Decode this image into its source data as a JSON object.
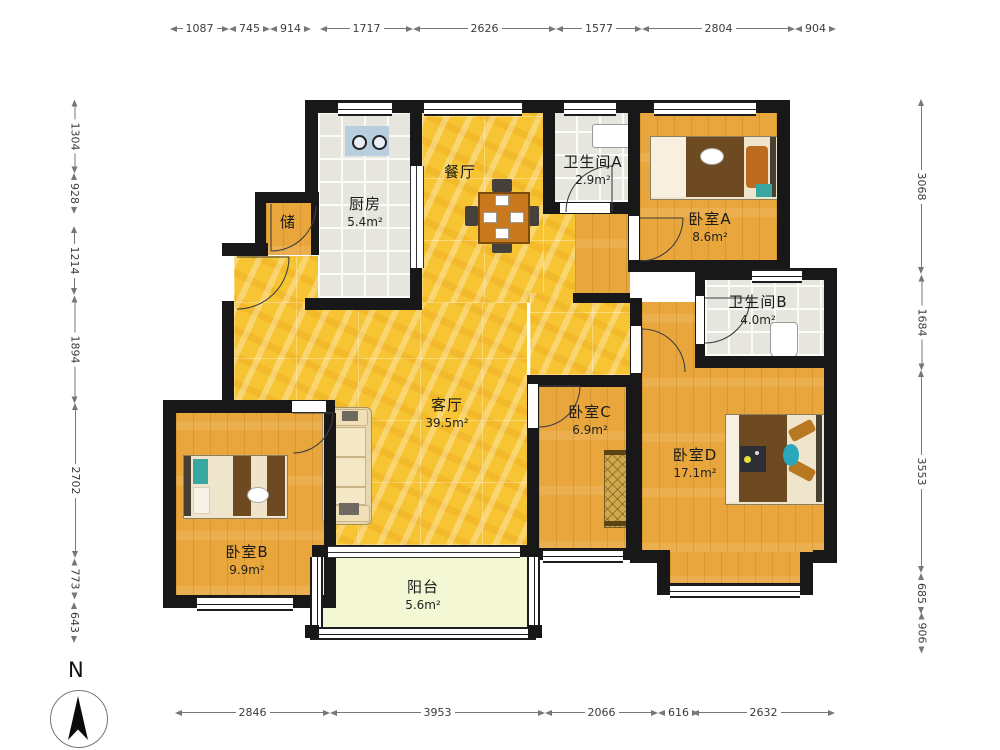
{
  "compass": {
    "north_label": "N"
  },
  "dims": {
    "top": [
      "1087",
      "745",
      "914",
      "1717",
      "2626",
      "1577",
      "2804",
      "904"
    ],
    "bottom": [
      "2846",
      "3953",
      "2066",
      "616",
      "2632"
    ],
    "left": [
      "1304",
      "928",
      "1214",
      "1894",
      "2702",
      "773",
      "643"
    ],
    "right": [
      "3068",
      "1684",
      "3553",
      "685",
      "906"
    ]
  },
  "rooms": {
    "kitchen": {
      "name": "厨房",
      "area": "5.4m²"
    },
    "dining": {
      "name": "餐厅",
      "area": ""
    },
    "bathA": {
      "name": "卫生间A",
      "area": "2.9m²"
    },
    "bedA": {
      "name": "卧室A",
      "area": "8.6m²"
    },
    "storage": {
      "name": "储",
      "area": ""
    },
    "bathB": {
      "name": "卫生间B",
      "area": "4.0m²"
    },
    "living": {
      "name": "客厅",
      "area": "39.5m²"
    },
    "bedC": {
      "name": "卧室C",
      "area": "6.9m²"
    },
    "bedD": {
      "name": "卧室D",
      "area": "17.1m²"
    },
    "bedB": {
      "name": "卧室B",
      "area": "9.9m²"
    },
    "balcony": {
      "name": "阳台",
      "area": "5.6m²"
    }
  },
  "colors": {
    "wall": "#181818",
    "wood_floor": "#e9a63c",
    "marble_floor": "#f7c433",
    "tile_floor": "#e6e6df",
    "balcony_floor": "#f4f7d4",
    "counter_blue": "#b9cede",
    "blanket_brown": "#6d4a22",
    "teal_accent": "#38a7a0"
  }
}
